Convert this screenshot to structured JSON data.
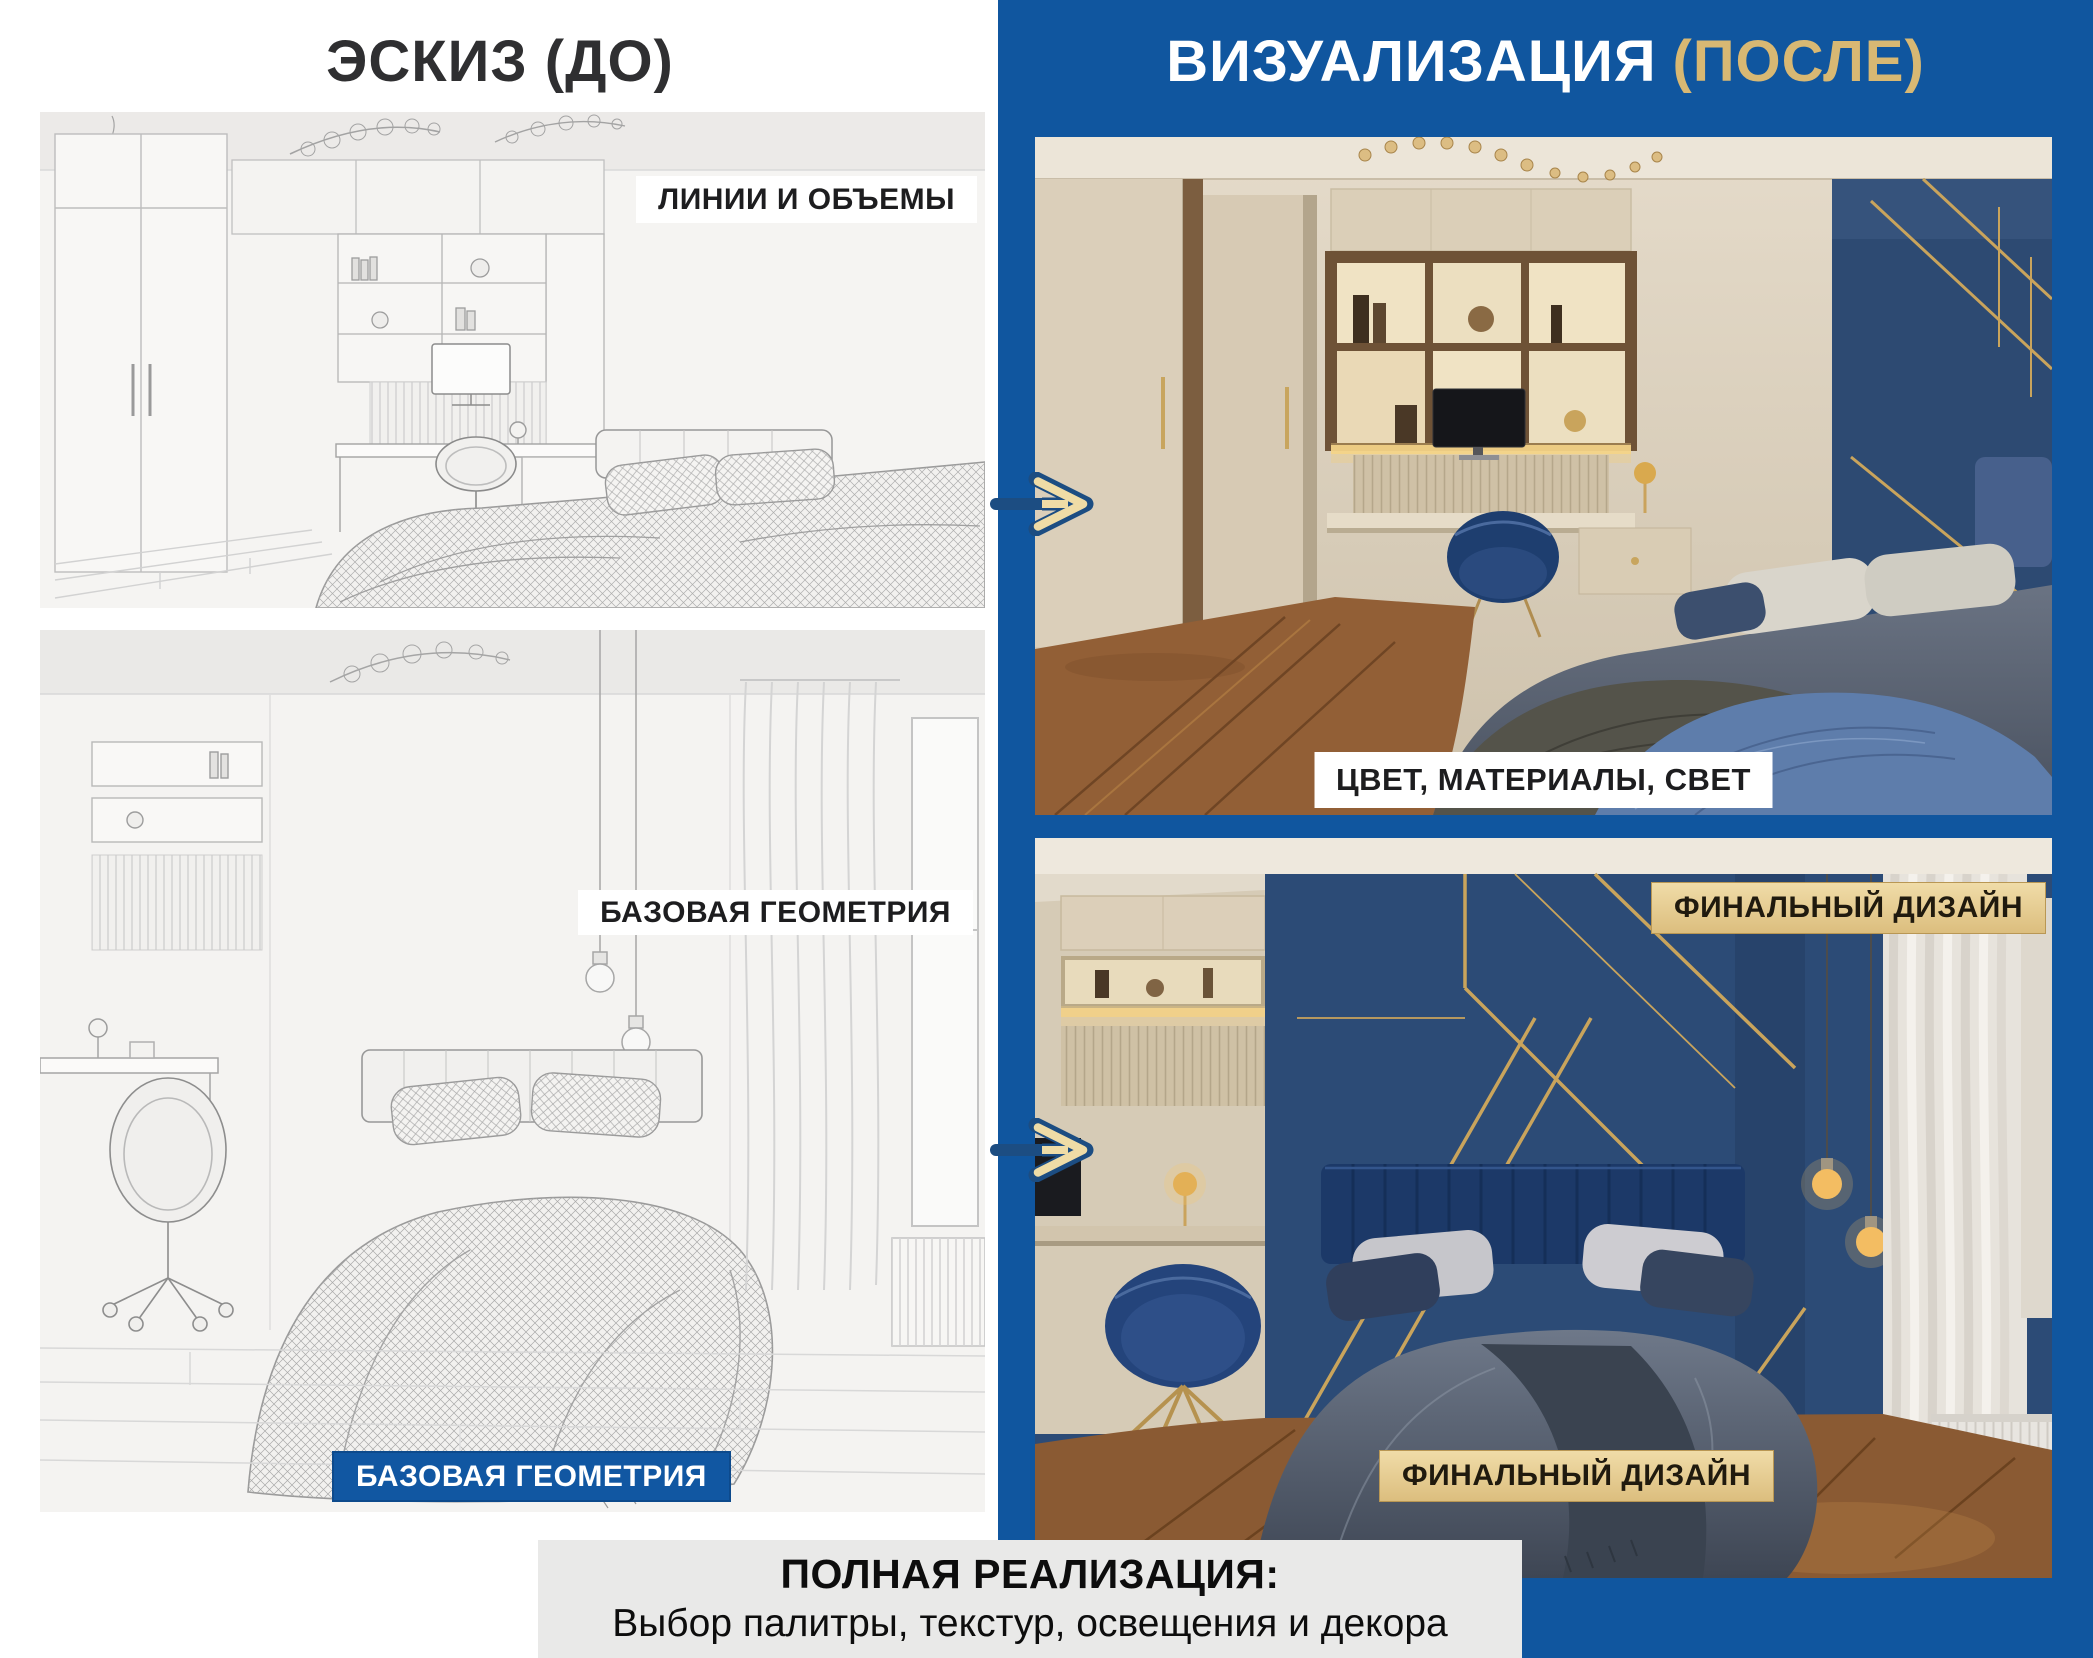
{
  "header": {
    "left_title": "ЭСКИЗ (ДО)",
    "right_title_main": "ВИЗУАЛИЗАЦИЯ",
    "right_title_accent": "(ПОСЛЕ)"
  },
  "panels": {
    "top_left": {
      "image": "bedroom-desk-wireframe-sketch",
      "label": "ЛИНИИ И ОБЪЕМЫ"
    },
    "top_right": {
      "image": "bedroom-desk-color-render",
      "label": "ЦВЕТ, МАТЕРИАЛЫ, СВЕТ"
    },
    "bottom_left": {
      "image": "bedroom-bed-wireframe-sketch",
      "label_top": "БАЗОВАЯ ГЕОМЕТРИЯ",
      "label_bottom": "БАЗОВАЯ ГЕОМЕТРИЯ"
    },
    "bottom_right": {
      "image": "bedroom-bed-color-render",
      "label_top": "ФИНАЛЬНЫЙ ДИЗАЙН",
      "label_bottom": "ФИНАЛЬНЫЙ ДИЗАЙН"
    }
  },
  "footer": {
    "title": "ПОЛНАЯ РЕАЛИЗАЦИЯ:",
    "subtitle": "Выбор палитры, текстур, освещения и декора"
  },
  "icons": {
    "arrow_1": "arrow-right",
    "arrow_2": "arrow-right"
  },
  "colors": {
    "panel_blue": "#10569f",
    "gold_accent": "#d8b873",
    "label_gold_bg": "#e5ca8d",
    "arrow_navy": "#1c4d82",
    "arrow_cream": "#efdca6",
    "footer_bg": "#e9e9e8"
  }
}
